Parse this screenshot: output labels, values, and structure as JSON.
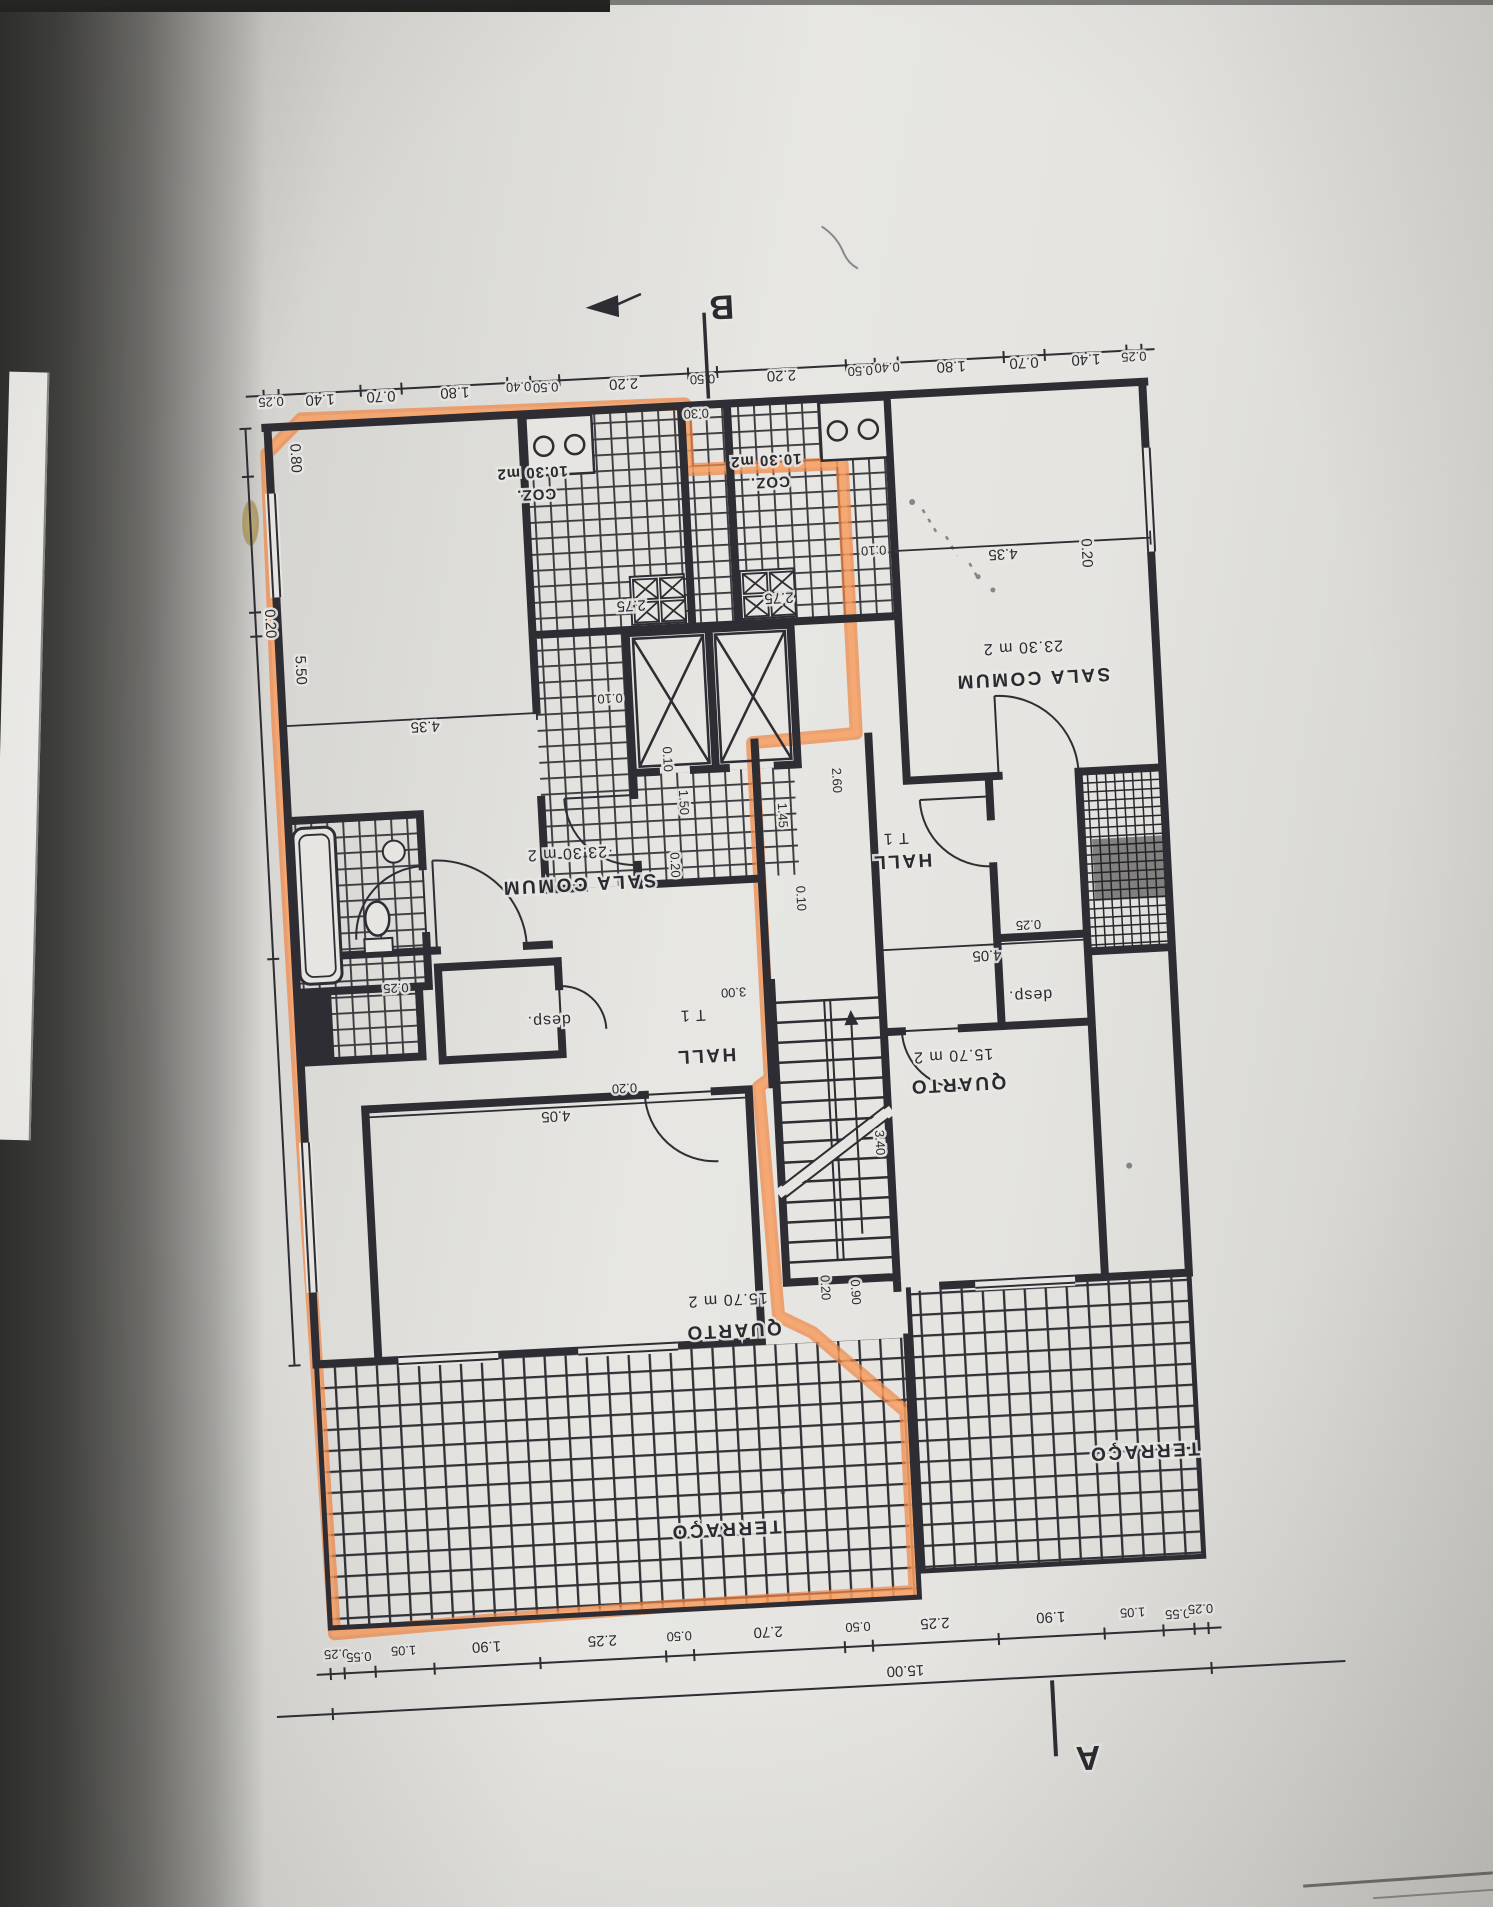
{
  "markers": {
    "a": "A",
    "b": "B"
  },
  "rooms": {
    "sala_left_area": "·23.30 m 2",
    "sala_left_name": "SALA COMUM",
    "sala_right_area": "23.30 m 2",
    "sala_right_name": "SALA COMUM",
    "coz_left_area": "10.30 m2",
    "coz_left_name": "COZ.",
    "coz_right_area": "10.30 m2",
    "coz_right_name": "COZ.",
    "t1_left": "T 1",
    "hall_left": "HALL",
    "t1_right": "T 1",
    "hall_right": "HALL",
    "desp_left": "desp.",
    "desp_right": "desp.",
    "quarto_left_area": "15.70 m 2",
    "quarto_left_name": "QUARTO",
    "quarto_right_area": "15.70 m 2",
    "quarto_right_name": "QUARTO",
    "terraco_left": "TERRAÇO",
    "terraco_right": "TERRAÇO"
  },
  "dims": {
    "top": [
      "0.25",
      "1.40",
      "0.70",
      "1.80",
      "0.40",
      "0.50",
      "2.20",
      "0.50",
      "2.20",
      "0.50",
      "0.40",
      "1.80",
      "0.70",
      "1.40",
      "0.25"
    ],
    "bottom": [
      "0.25",
      "0.55",
      "1.05",
      "1.90",
      "2.25",
      "0.50",
      "2.70",
      "0.50",
      "2.25",
      "1.90",
      "1.05",
      "0.55",
      "0.25"
    ],
    "bottom_total": "15.00",
    "misc": {
      "d030": "0.30",
      "d080": "0.80",
      "d020a": "0.20",
      "d550": "5.50",
      "d025l": "0.25",
      "d435l": "4.35",
      "d010l": "0.10",
      "d275l": "2.75",
      "d275r": "2.75",
      "d435r": "4.35",
      "d010r": "0.10",
      "d020v": "0.20",
      "d145": "1.45",
      "d010c": "0.10",
      "d150": "1.50",
      "d020c": "0.20",
      "d260": "2.60",
      "d340": "3.40",
      "d300": "3.00",
      "d020s": "0.20",
      "d090": "0.90",
      "d010s": "0.10",
      "d405l": "4.05",
      "d020q": "0.20",
      "d405r": "4.05",
      "d025r": "0.25"
    }
  },
  "colors": {
    "highlight": "#ef8746",
    "ink": "#2d2d33",
    "paper": "#e6e5e1"
  }
}
